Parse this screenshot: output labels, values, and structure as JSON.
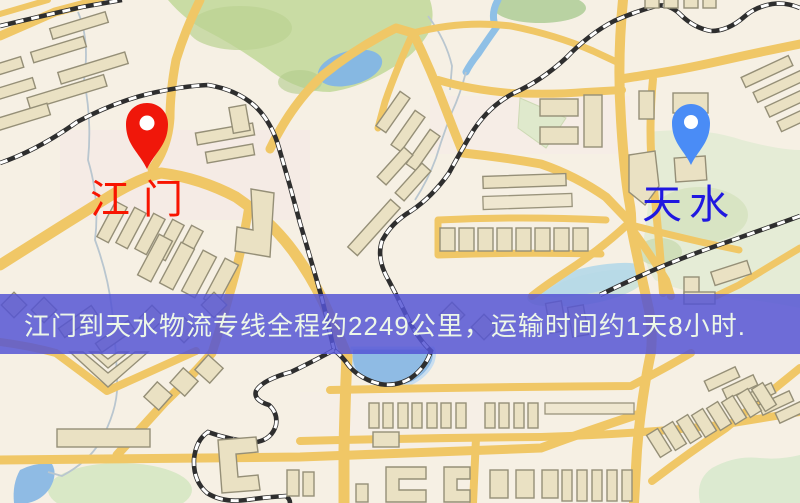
{
  "map": {
    "origin": {
      "name": "江门",
      "pin_color": "#f0170a",
      "label_color": "#f81400"
    },
    "destination": {
      "name": "天水",
      "pin_color": "#4a8cf6",
      "label_color": "#2018e0"
    },
    "banner": {
      "text": "江门到天水物流专线全程约2249公里，运输时间约1天8小时.",
      "bg_color": "#5454d4",
      "text_color": "#edf7e8"
    },
    "legend_colors": {
      "road": "#f0c766",
      "railway": "#2e2e2e",
      "building": "#eae1c3",
      "park": "#c9dca4",
      "water": "#8fbbe4",
      "background": "#f6f0e4"
    }
  }
}
